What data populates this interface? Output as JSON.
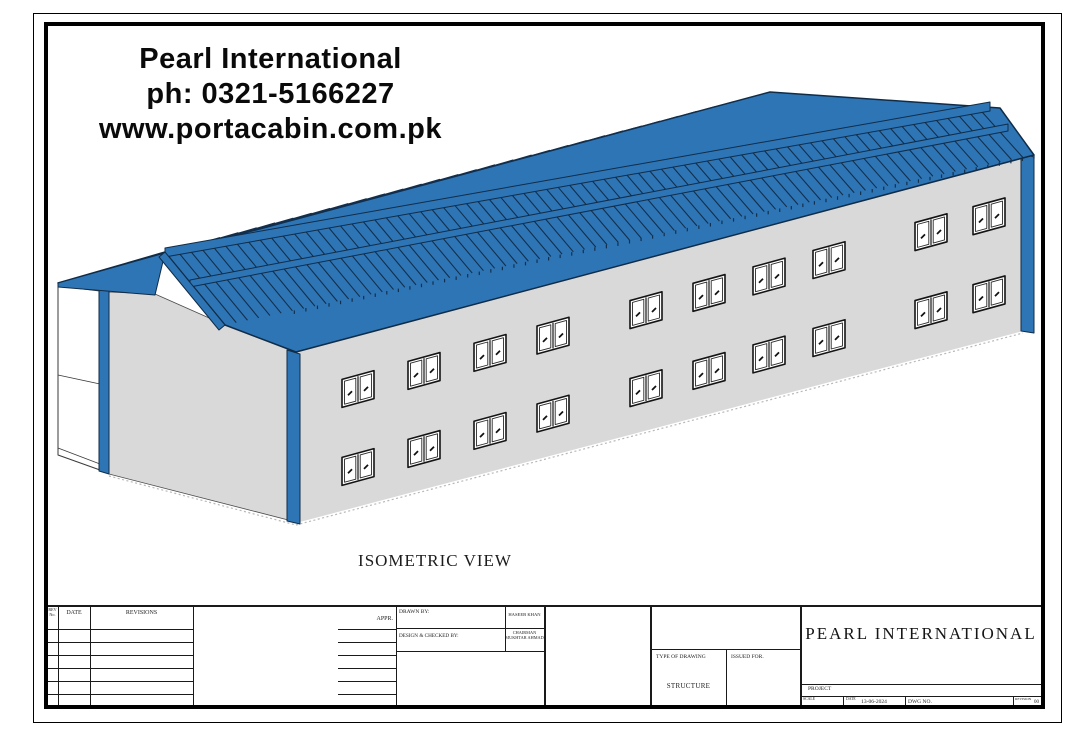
{
  "watermark": {
    "line1": "Pearl International",
    "line2": "ph: 0321-5166227",
    "line3": "www.portacabin.com.pk"
  },
  "view_label": "ISOMETRIC VIEW",
  "title_block": {
    "rev_no_label": "REV No.",
    "date_col_label": "DATE",
    "revisions_label": "REVISIONS",
    "appr_label": "APPR.",
    "drawn_by_label": "DRAWN BY:",
    "drawn_by_value": "HASEEB KHAN",
    "design_checked_label": "DESIGN & CHECKED BY:",
    "design_checked_value": "CHAIRMAN MUKHTAR AHMAD",
    "type_of_drawing_label": "TYPE OF DRAWING",
    "type_of_drawing_value": "STRUCTURE",
    "issued_for_label": "ISSUED FOR.",
    "company_name": "PEARL INTERNATIONAL",
    "project_label": "PROJECT",
    "scale_label": "SCALE",
    "date_label": "DATE",
    "date_value": "13-06-2024",
    "dwg_no_label": "DWG NO.",
    "revision_label": "REVISION",
    "revision_value": "00"
  },
  "drawing": {
    "colors": {
      "roof_blue": "#2e75b6",
      "stripe_dark": "#132f4c",
      "wall_gray": "#d9d9d9",
      "outline": "#102c47",
      "window_white": "#ffffff",
      "ground_gray": "#b8b8b8"
    },
    "windows": {
      "x_positions": [
        342,
        408,
        474,
        537,
        630,
        693,
        753,
        813,
        915,
        973
      ],
      "pair_width": 32,
      "height": 28,
      "upper_offset": 40,
      "lower_offset": 118,
      "rows": 2,
      "count_total": 20
    }
  }
}
